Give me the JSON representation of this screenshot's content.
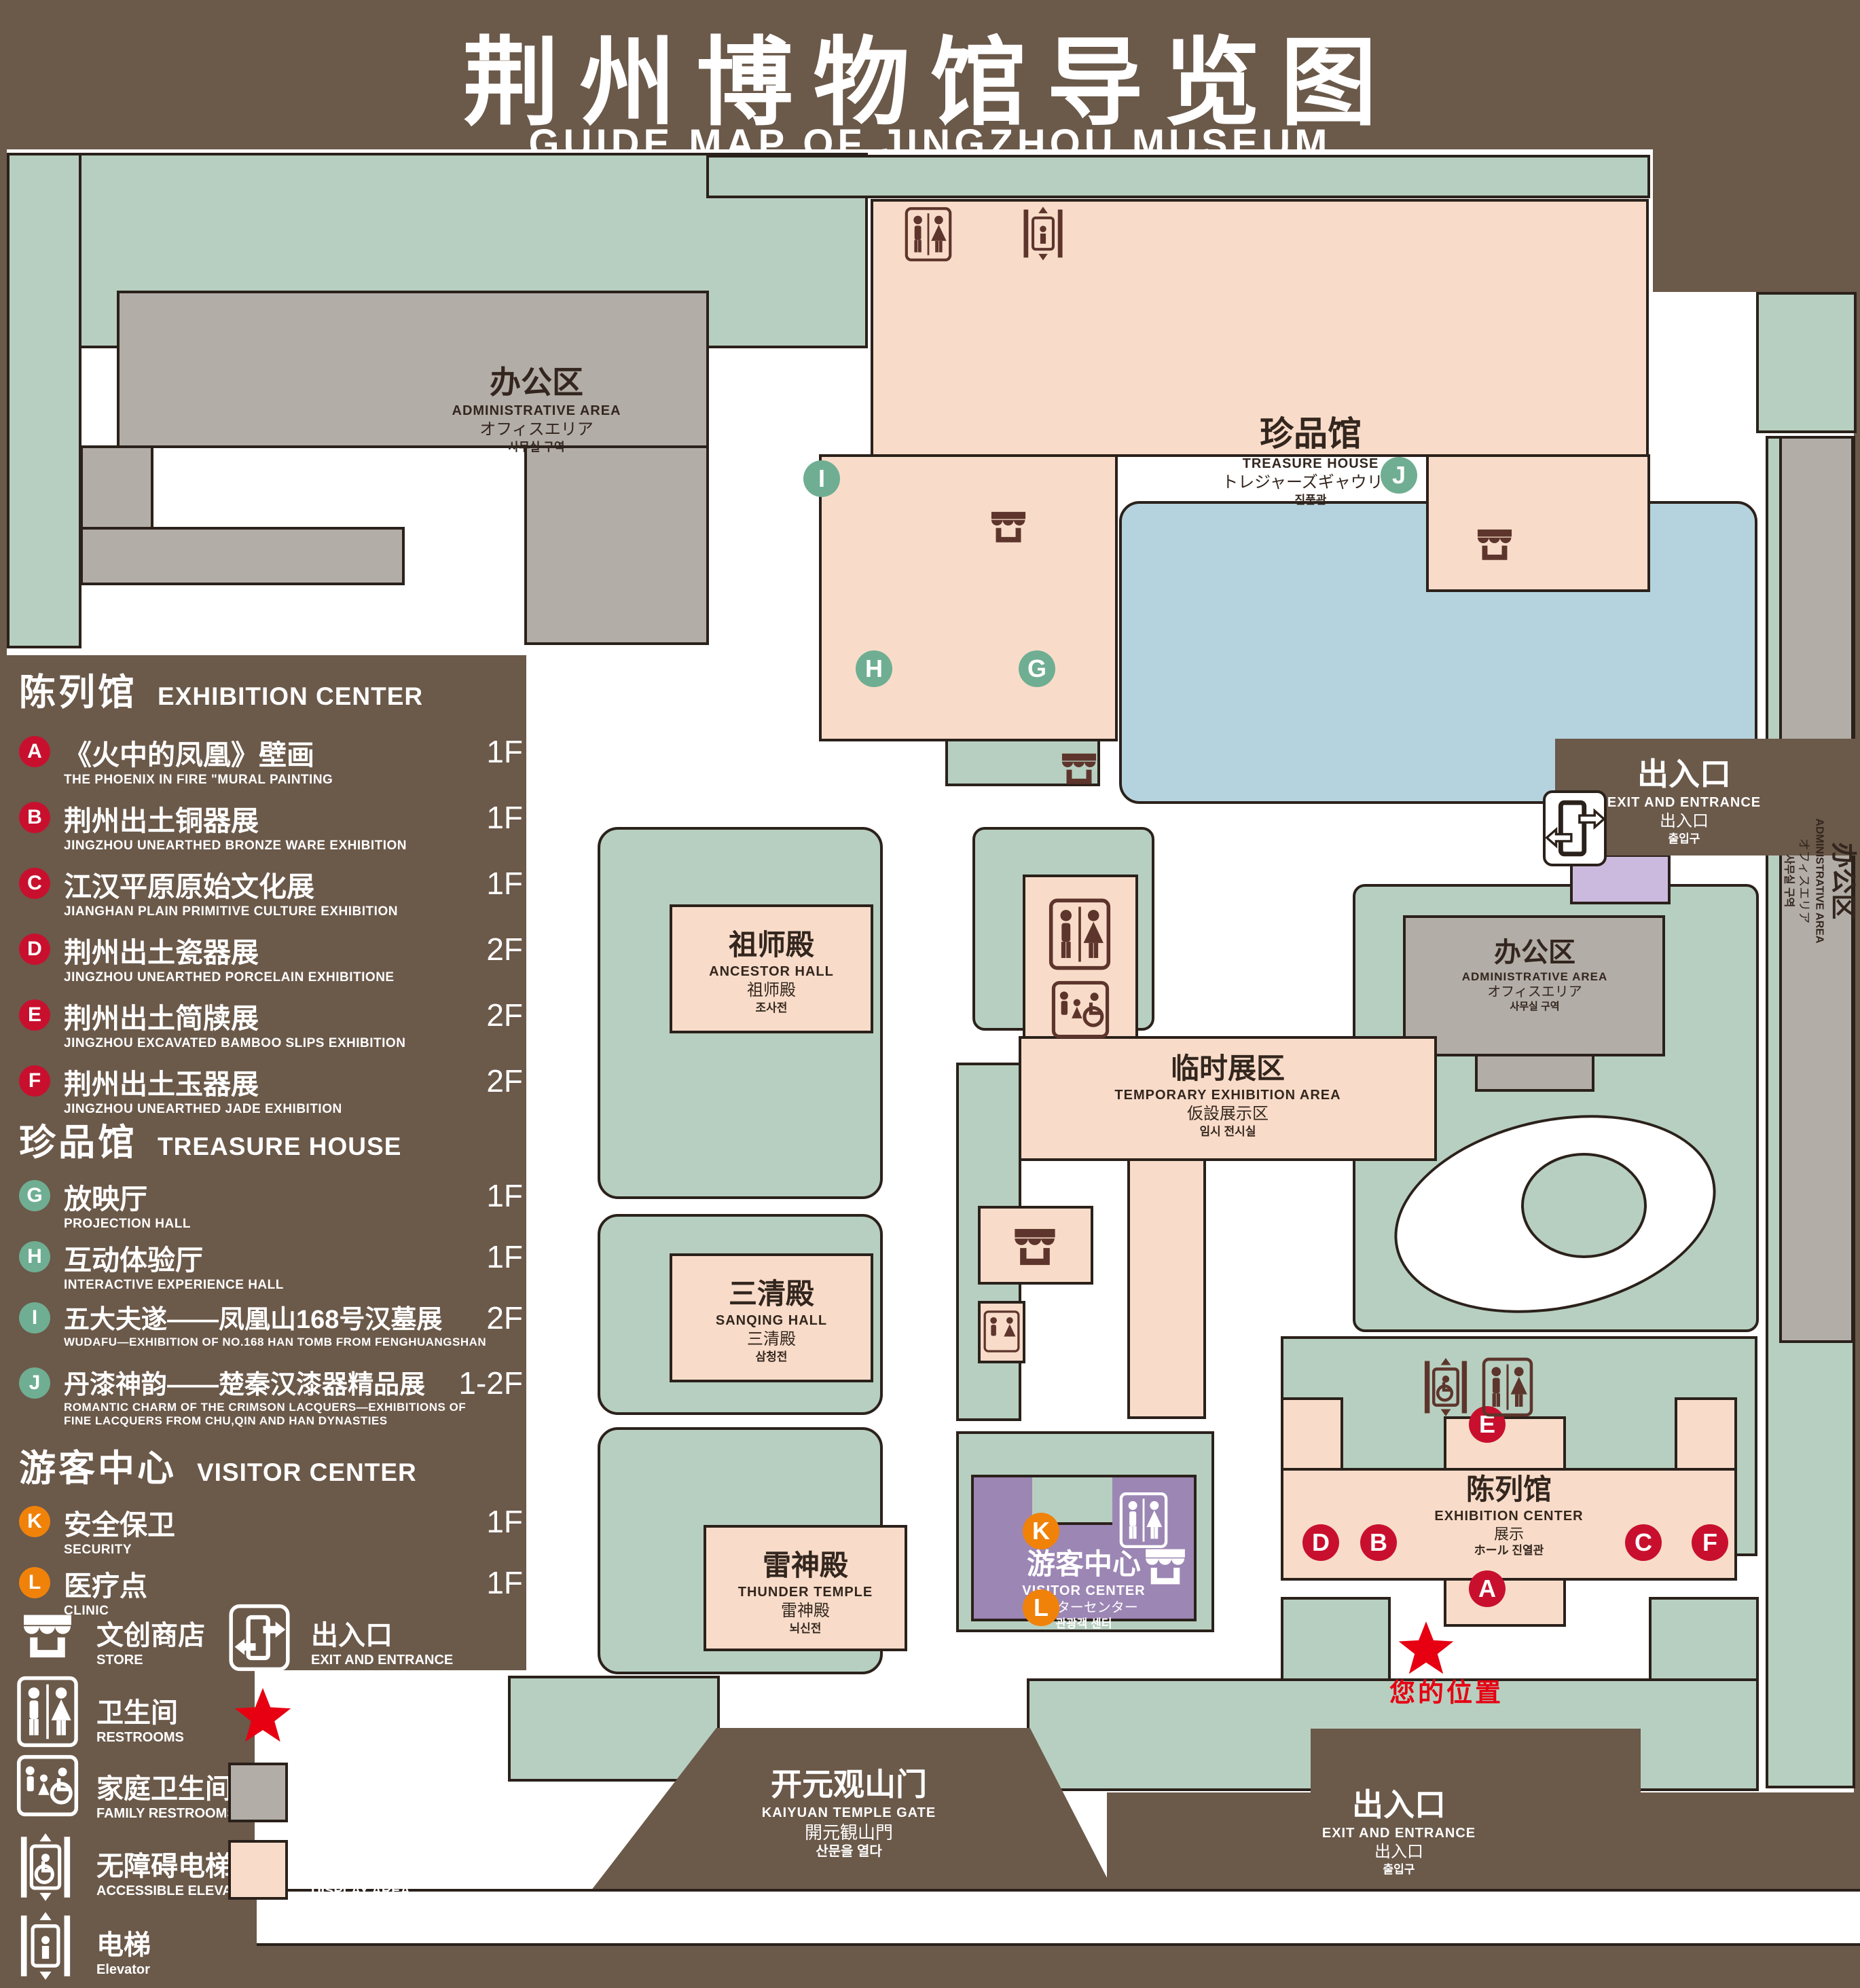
{
  "header": {
    "title_zh": "荆州博物馆导览图",
    "title_en": "GUIDE MAP OF JINGZHOU MUSEUM"
  },
  "legend": {
    "exhibition": {
      "title_zh": "陈列馆",
      "title_en": "EXHIBITION CENTER",
      "items": [
        {
          "id": "A",
          "zh": "《火中的凤凰》壁画",
          "en": "THE PHOENIX IN FIRE \"MURAL PAINTING",
          "floor": "1F"
        },
        {
          "id": "B",
          "zh": "荆州出土铜器展",
          "en": "JINGZHOU UNEARTHED BRONZE WARE EXHIBITION",
          "floor": "1F"
        },
        {
          "id": "C",
          "zh": "江汉平原原始文化展",
          "en": "JIANGHAN PLAIN PRIMITIVE CULTURE EXHIBITION",
          "floor": "1F"
        },
        {
          "id": "D",
          "zh": "荆州出土瓷器展",
          "en": "JINGZHOU UNEARTHED PORCELAIN EXHIBITIONE",
          "floor": "2F"
        },
        {
          "id": "E",
          "zh": "荆州出土简牍展",
          "en": "JINGZHOU EXCAVATED BAMBOO SLIPS EXHIBITION",
          "floor": "2F"
        },
        {
          "id": "F",
          "zh": "荆州出土玉器展",
          "en": "JINGZHOU UNEARTHED JADE EXHIBITION",
          "floor": "2F"
        }
      ]
    },
    "treasure": {
      "title_zh": "珍品馆",
      "title_en": "TREASURE HOUSE",
      "items": [
        {
          "id": "G",
          "zh": "放映厅",
          "en": "PROJECTION HALL",
          "floor": "1F"
        },
        {
          "id": "H",
          "zh": "互动体验厅",
          "en": "INTERACTIVE EXPERIENCE HALL",
          "floor": "1F"
        },
        {
          "id": "I",
          "zh": "五大夫遂——凤凰山168号汉墓展",
          "en": "WUDAFU—EXHIBITION OF NO.168 HAN TOMB FROM FENGHUANGSHAN",
          "floor": "2F"
        },
        {
          "id": "J",
          "zh": "丹漆神韵——楚秦汉漆器精品展",
          "en": "ROMANTIC CHARM OF THE CRIMSON LACQUERS—EXHIBITIONS OF FINE LACQUERS FROM CHU,QIN AND HAN DYNASTIES",
          "floor": "1-2F"
        }
      ]
    },
    "visitor": {
      "title_zh": "游客中心",
      "title_en": "VISITOR CENTER",
      "items": [
        {
          "id": "K",
          "zh": "安全保卫",
          "en": "SECURITY",
          "floor": "1F"
        },
        {
          "id": "L",
          "zh": "医疗点",
          "en": "CLINIC",
          "floor": "1F"
        }
      ]
    },
    "symbols": {
      "store": {
        "zh": "文创商店",
        "en": "STORE"
      },
      "exit": {
        "zh": "出入口",
        "en": "EXIT AND ENTRANCE"
      },
      "restrooms": {
        "zh": "卫生间",
        "en": "RESTROOMS"
      },
      "your_location": {
        "zh": "您的位置",
        "en": "YOUR LOCATION"
      },
      "family_restrooms": {
        "zh": "家庭卫生间",
        "en": "FAMILY RESTROOMS"
      },
      "office_area": {
        "zh": "办公区域",
        "en": "OFFICE AREA"
      },
      "accessible_elevator": {
        "zh": "无障碍电梯",
        "en": "ACCESSIBLE ELEVATOR"
      },
      "display_area": {
        "zh": "展示区域",
        "en": "DISPLAY AREA"
      },
      "elevator": {
        "zh": "电梯",
        "en": "Elevator"
      }
    }
  },
  "map": {
    "buildings": {
      "admin": {
        "zh": "办公区",
        "en": "ADMINISTRATIVE AREA",
        "ja": "オフィスエリア",
        "ko": "사무실 구역"
      },
      "treasure": {
        "zh": "珍品馆",
        "en": "TREASURE HOUSE",
        "ja": "トレジャーズギャウリー",
        "ko": "진품관"
      },
      "ancestor": {
        "zh": "祖师殿",
        "en": "ANCESTOR HALL",
        "ja": "祖师殿",
        "ko": "조사전"
      },
      "temporary": {
        "zh": "临时展区",
        "en": "TEMPORARY EXHIBITION AREA",
        "ja": "仮設展示区",
        "ko": "임시 전시실"
      },
      "sanqing": {
        "zh": "三清殿",
        "en": "SANQING HALL",
        "ja": "三清殿",
        "ko": "삼청전"
      },
      "thunder": {
        "zh": "雷神殿",
        "en": "THUNDER TEMPLE",
        "ja": "雷神殿",
        "ko": "뇌신전"
      },
      "exhibition": {
        "zh": "陈列馆",
        "en": "EXHIBITION CENTER",
        "ja": "展示",
        "ko": "ホール 진열관"
      },
      "visitor": {
        "zh": "游客中心",
        "en": "VISITOR CENTER",
        "ja": "ビジターセンター",
        "ko": "관광객 센터"
      },
      "gate": {
        "zh": "开元观山门",
        "en": "KAIYUAN TEMPLE GATE",
        "ja": "開元観山門",
        "ko": "산문을 열다"
      },
      "exit": {
        "zh": "出入口",
        "en": "EXIT AND ENTRANCE",
        "ja": "出入口",
        "ko": "출입구"
      }
    },
    "markers": {
      "a": "A",
      "b": "B",
      "c": "C",
      "d": "D",
      "e": "E",
      "f": "F",
      "g": "G",
      "h": "H",
      "i": "I",
      "j": "J",
      "k": "K",
      "l": "L"
    },
    "your_location": "您的位置",
    "road": "荆 州 中 路"
  },
  "colors": {
    "background": "#6b594a",
    "landscape_green": "#b7cfc0",
    "display_pink": "#f8dcc9",
    "office_gray": "#b3ada7",
    "water_blue": "#b5d3de",
    "visitor_purple": "#9c86b4",
    "entrance_lavender": "#ccbade",
    "marker_red": "#c8102e",
    "marker_green": "#6fae92",
    "marker_orange": "#f0820a",
    "location_red": "#e60012"
  }
}
